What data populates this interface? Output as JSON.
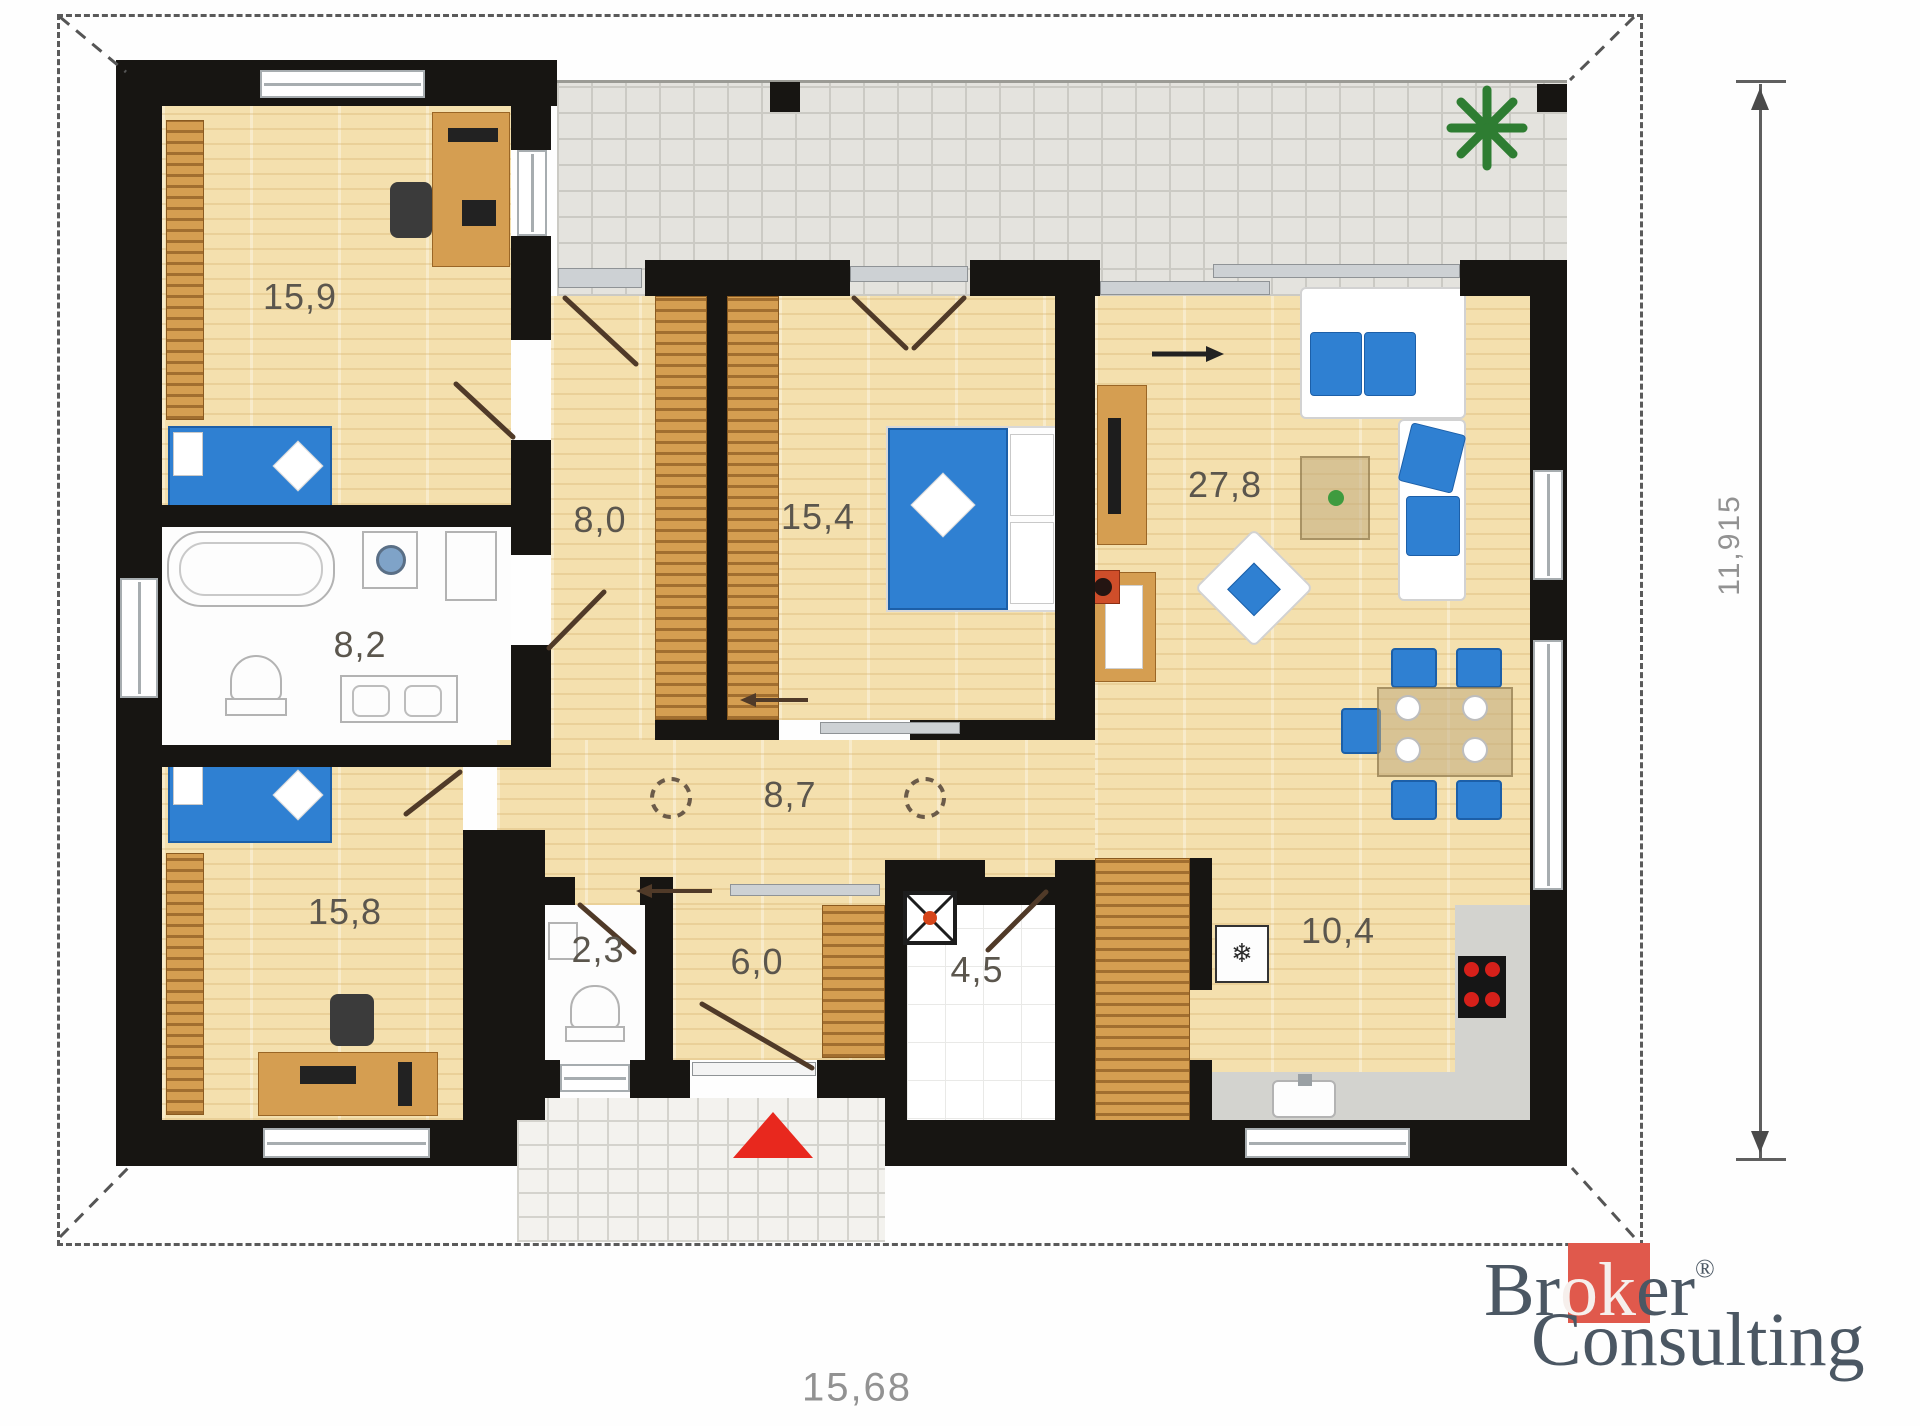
{
  "rooms": [
    {
      "name": "bedroom-top-left",
      "area": "15,9"
    },
    {
      "name": "hall",
      "area": "8,0"
    },
    {
      "name": "bedroom-middle",
      "area": "15,4"
    },
    {
      "name": "living-room",
      "area": "27,8"
    },
    {
      "name": "bathroom",
      "area": "8,2"
    },
    {
      "name": "corridor",
      "area": "8,7"
    },
    {
      "name": "bedroom-bottom-left",
      "area": "15,8"
    },
    {
      "name": "wc",
      "area": "2,3"
    },
    {
      "name": "entry-hall",
      "area": "6,0"
    },
    {
      "name": "technical-room",
      "area": "4,5"
    },
    {
      "name": "kitchen",
      "area": "10,4"
    }
  ],
  "dimensions": {
    "bottom": "15,68",
    "right": "11,915"
  },
  "symbols": {
    "fridge": "❄"
  },
  "logo": {
    "word1_pre": "Br",
    "word1_highlight": "ok",
    "word1_post": "er",
    "registered": "®",
    "word2": "Consulting",
    "red": "#e0594c",
    "text_color": "#4b5763"
  },
  "colors": {
    "wall": "#171512",
    "wood_floor": "#f4e0ae",
    "furniture_wood": "#d59e51",
    "accent_blue": "#2f80d2",
    "terrace_tile": "#e4e3de",
    "entrance_marker_red": "#e8281e"
  }
}
